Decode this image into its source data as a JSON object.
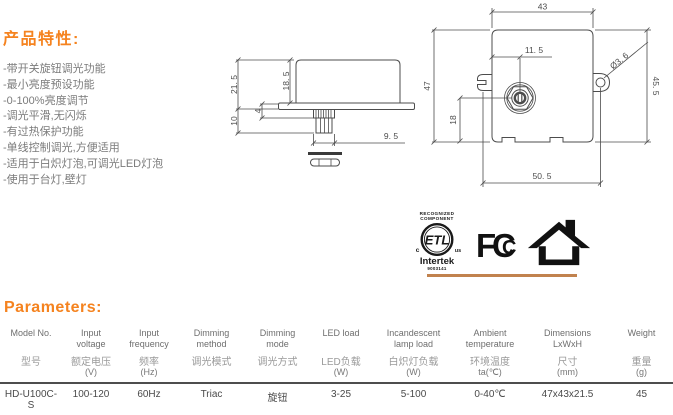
{
  "features": {
    "title": "产品特性:",
    "items": [
      "-带开关旋钮调光功能",
      "-最小亮度预设功能",
      "-0-100%亮度调节",
      "-调光平滑,无闪烁",
      "-有过热保护功能",
      "-单线控制调光,方便适用",
      "-适用于白炽灯泡,可调光LED灯泡",
      "-使用于台灯,壁灯"
    ]
  },
  "drawing": {
    "side_view": {
      "dim_total_height": "21. 5",
      "dim_body_height": "18. 5",
      "dim_under_height": "10",
      "dim_flange_shaft": "4",
      "dim_shaft_width": "9. 5"
    },
    "front_view": {
      "dim_width": "43",
      "dim_height_left": "47",
      "dim_knob_offset": "11. 5",
      "dim_hole": "Ø3. 6",
      "dim_height_right": "45. 5",
      "dim_knob_to_bottom": "18",
      "dim_mount_span": "50. 5"
    }
  },
  "certifications": {
    "etl": {
      "line1": "RECOGNIZED",
      "line2": "COMPONENT",
      "mark": "ETL",
      "c": "c",
      "us": "us",
      "intertek": "Intertek",
      "number": "9003141"
    },
    "fcc": {
      "f": "F",
      "c_outer": "C",
      "c_inner": "C"
    }
  },
  "parameters": {
    "title": "Parameters:",
    "columns": [
      {
        "en": "Model No.",
        "cn": "型号",
        "unit": ""
      },
      {
        "en": "Input voltage",
        "cn": "额定电压",
        "unit": "(V)"
      },
      {
        "en": "Input frequency",
        "cn": "频率",
        "unit": "(Hz)"
      },
      {
        "en": "Dimming method",
        "cn": "调光模式",
        "unit": ""
      },
      {
        "en": "Dimming mode",
        "cn": "调光方式",
        "unit": ""
      },
      {
        "en": "LED load",
        "cn": "LED负载",
        "unit": "(W)"
      },
      {
        "en": "Incandescent lamp load",
        "cn": "白炽灯负载",
        "unit": "(W)"
      },
      {
        "en": "Ambient temperature",
        "cn": "环境温度",
        "unit": "ta(℃)"
      },
      {
        "en": "Dimensions LxWxH",
        "cn": "尺寸",
        "unit": "(mm)"
      },
      {
        "en": "Weight",
        "cn": "重量",
        "unit": "(g)"
      }
    ],
    "row": [
      "HD-U100C-S",
      "100-120",
      "60Hz",
      "Triac",
      "旋钮",
      "3-25",
      "5-100",
      "0-40℃",
      "47x43x21.5",
      "45"
    ]
  },
  "colors": {
    "accent": "#F5831F",
    "divider": "#C1824E",
    "body_text": "#7b7b7b",
    "drawing": "#4c4c4c"
  }
}
